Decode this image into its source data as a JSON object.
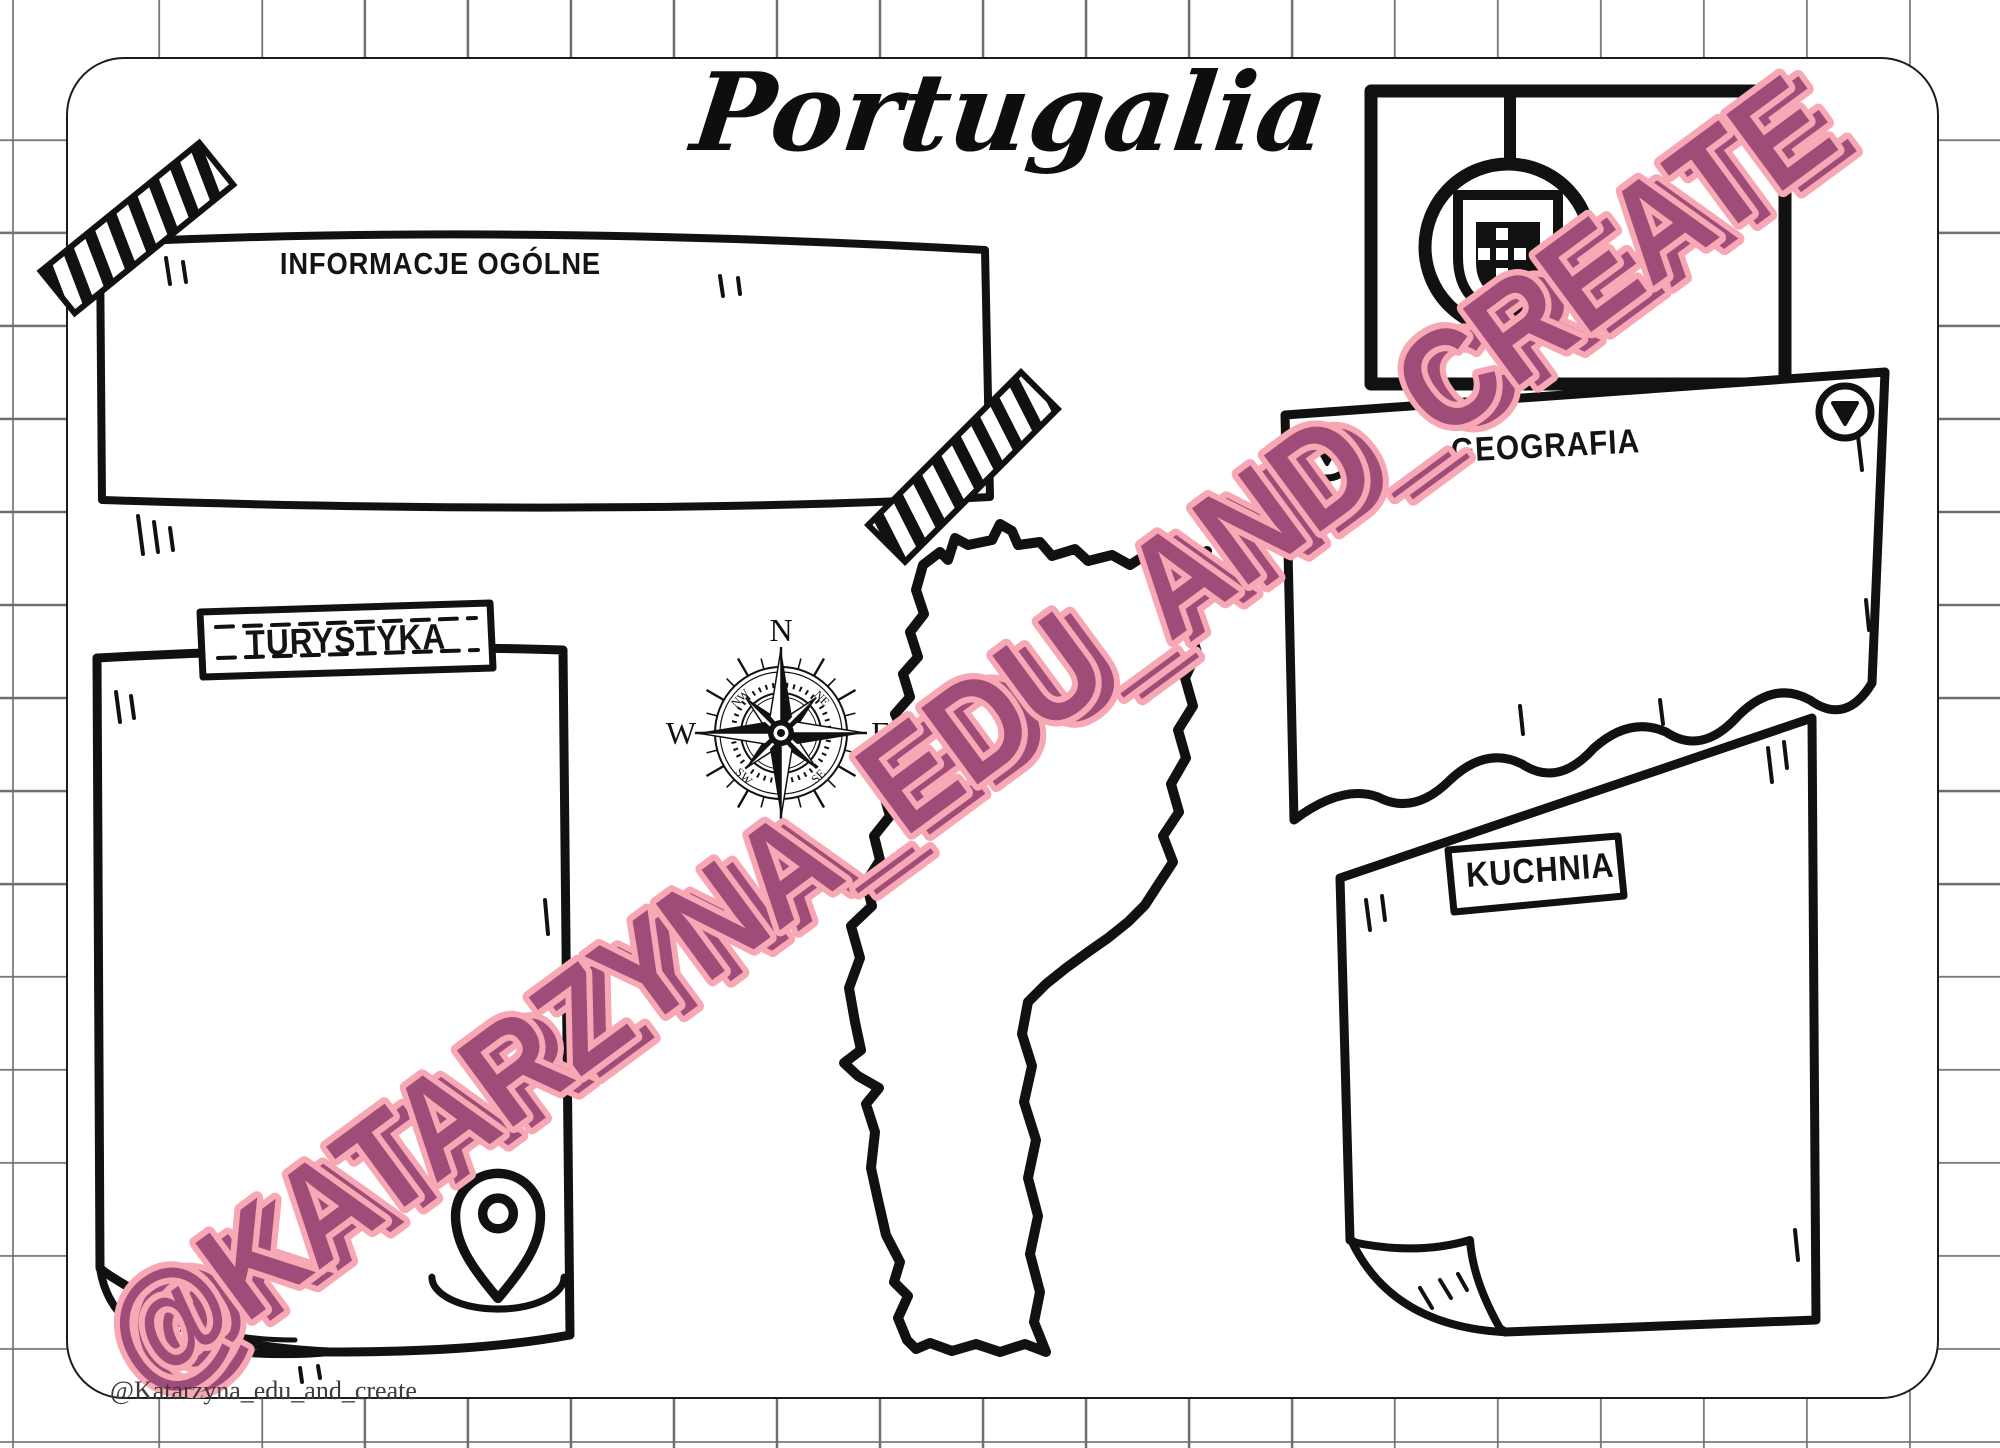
{
  "page": {
    "title": "Portugalia",
    "credit": "@Katarzyna_edu_and_create"
  },
  "sections": {
    "general_info": {
      "label": "INFORMACJE OGÓLNE"
    },
    "tourism": {
      "label": "TURYSTYKA"
    },
    "geography": {
      "label": "GEOGRAFIA"
    },
    "cuisine": {
      "label": "KUCHNIA"
    }
  },
  "compass": {
    "north": "N",
    "east": "E",
    "south": "S",
    "west": "W",
    "northwest": "NW",
    "northeast": "NE",
    "southwest": "SW",
    "southeast": "SE"
  },
  "watermark": {
    "text": "@KATARZYNA_EDU_AND_CREATE",
    "fill_color": "#a04c79",
    "outline_color": "#f7a8b4"
  },
  "colors": {
    "ink": "#111111",
    "paper": "#ffffff",
    "grid_line": "#6e6e6e"
  },
  "icons": {
    "flag": "flag-of-portugal",
    "tape": "washi-tape",
    "pushpin": "pushpin",
    "compass": "compass-rose",
    "pin": "location-pin",
    "map": "portugal-map-outline"
  }
}
